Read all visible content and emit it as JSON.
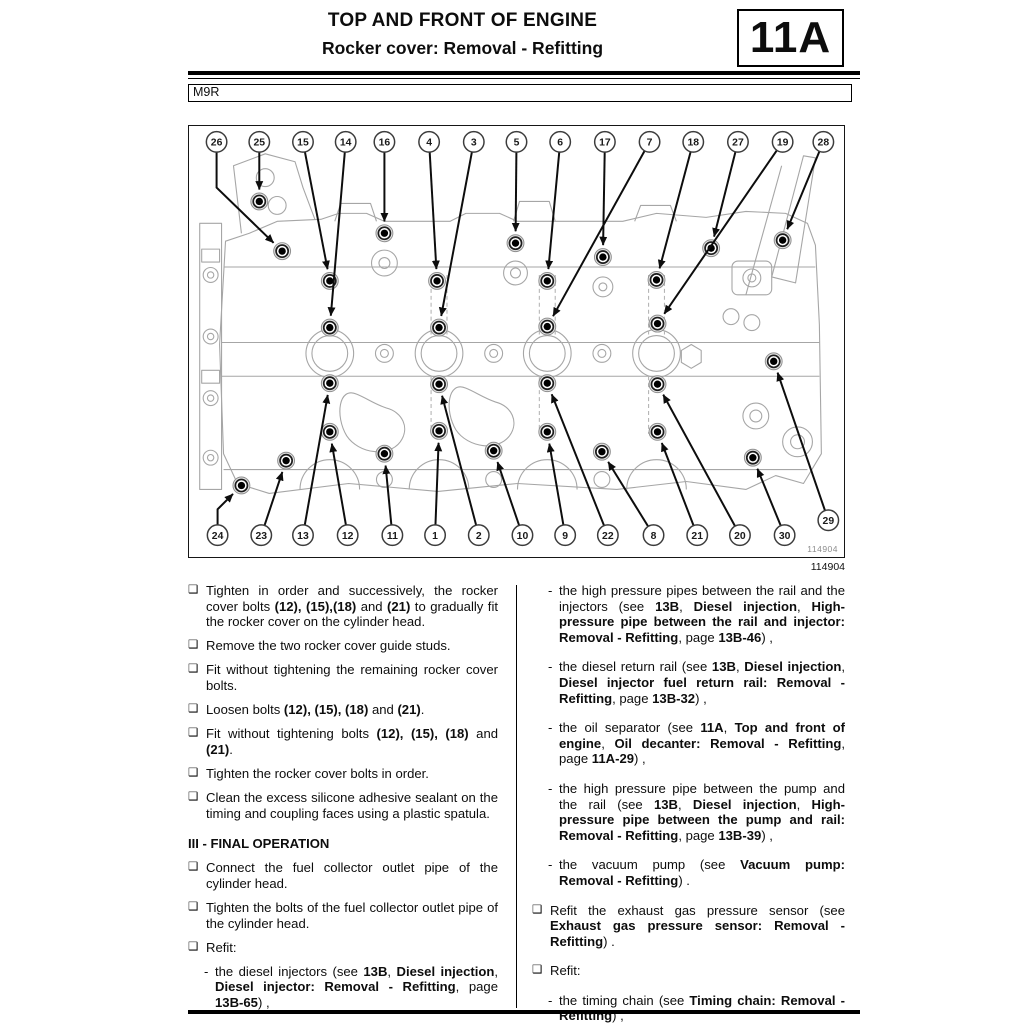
{
  "header": {
    "title_line1": "TOP AND FRONT OF ENGINE",
    "title_line2": "Rocker cover: Removal - Refitting",
    "section_code": "11A",
    "engine_code": "M9R"
  },
  "markers": {
    "bullet": "❑",
    "dash": "-"
  },
  "figure": {
    "image_number": "114904",
    "callouts": [
      {
        "label": "26",
        "c": [
          27,
          16
        ],
        "v": [
          [
            27,
            62
          ]
        ],
        "t": [
          93,
          126
        ]
      },
      {
        "label": "25",
        "c": [
          70,
          16
        ],
        "t": [
          70,
          76
        ]
      },
      {
        "label": "15",
        "c": [
          114,
          16
        ],
        "t": [
          141,
          156
        ]
      },
      {
        "label": "14",
        "c": [
          157,
          16
        ],
        "t": [
          141,
          203
        ]
      },
      {
        "label": "16",
        "c": [
          196,
          16
        ],
        "t": [
          196,
          108
        ]
      },
      {
        "label": "4",
        "c": [
          241,
          16
        ],
        "t": [
          249,
          156
        ]
      },
      {
        "label": "3",
        "c": [
          286,
          16
        ],
        "t": [
          251,
          203
        ]
      },
      {
        "label": "5",
        "c": [
          329,
          16
        ],
        "t": [
          328,
          118
        ]
      },
      {
        "label": "6",
        "c": [
          373,
          16
        ],
        "t": [
          360,
          156
        ]
      },
      {
        "label": "17",
        "c": [
          418,
          16
        ],
        "t": [
          416,
          132
        ]
      },
      {
        "label": "7",
        "c": [
          463,
          16
        ],
        "t": [
          360,
          202
        ]
      },
      {
        "label": "18",
        "c": [
          507,
          16
        ],
        "t": [
          470,
          155
        ]
      },
      {
        "label": "27",
        "c": [
          552,
          16
        ],
        "t": [
          525,
          123
        ]
      },
      {
        "label": "19",
        "c": [
          597,
          16
        ],
        "t": [
          471,
          199
        ]
      },
      {
        "label": "28",
        "c": [
          638,
          16
        ],
        "t": [
          597,
          115
        ]
      },
      {
        "label": "24",
        "c": [
          28,
          412
        ],
        "v": [
          [
            28,
            386
          ]
        ],
        "t": [
          52,
          362
        ]
      },
      {
        "label": "23",
        "c": [
          72,
          412
        ],
        "t": [
          97,
          337
        ]
      },
      {
        "label": "13",
        "c": [
          114,
          412
        ],
        "t": [
          141,
          259
        ]
      },
      {
        "label": "12",
        "c": [
          159,
          412
        ],
        "t": [
          141,
          308
        ]
      },
      {
        "label": "11",
        "c": [
          204,
          412
        ],
        "t": [
          196,
          330
        ]
      },
      {
        "label": "1",
        "c": [
          247,
          412
        ],
        "t": [
          251,
          307
        ]
      },
      {
        "label": "2",
        "c": [
          291,
          412
        ],
        "t": [
          251,
          260
        ]
      },
      {
        "label": "10",
        "c": [
          335,
          412
        ],
        "t": [
          306,
          327
        ]
      },
      {
        "label": "9",
        "c": [
          378,
          412
        ],
        "t": [
          360,
          308
        ]
      },
      {
        "label": "22",
        "c": [
          421,
          412
        ],
        "t": [
          360,
          259
        ]
      },
      {
        "label": "8",
        "c": [
          467,
          412
        ],
        "t": [
          415,
          328
        ]
      },
      {
        "label": "21",
        "c": [
          511,
          412
        ],
        "t": [
          471,
          308
        ]
      },
      {
        "label": "20",
        "c": [
          554,
          412
        ],
        "t": [
          471,
          260
        ]
      },
      {
        "label": "30",
        "c": [
          599,
          412
        ],
        "t": [
          567,
          334
        ]
      },
      {
        "label": "29",
        "c": [
          643,
          397
        ],
        "t": [
          588,
          237
        ]
      }
    ]
  },
  "left_column": {
    "items": [
      {
        "kind": "bullet",
        "segments": [
          {
            "t": "Tighten in order and successively, the rocker cover bolts "
          },
          {
            "t": "(12), (15),(18)",
            "b": true
          },
          {
            "t": " and "
          },
          {
            "t": "(21)",
            "b": true
          },
          {
            "t": " to gradually fit the rocker cover on the cylinder head."
          }
        ]
      },
      {
        "kind": "bullet",
        "segments": [
          {
            "t": "Remove the two rocker cover guide studs."
          }
        ]
      },
      {
        "kind": "bullet",
        "segments": [
          {
            "t": "Fit without tightening the remaining rocker cover bolts."
          }
        ]
      },
      {
        "kind": "bullet",
        "segments": [
          {
            "t": "Loosen bolts "
          },
          {
            "t": "(12), (15), (18)",
            "b": true
          },
          {
            "t": " and "
          },
          {
            "t": "(21)",
            "b": true
          },
          {
            "t": "."
          }
        ]
      },
      {
        "kind": "bullet",
        "segments": [
          {
            "t": "Fit without tightening bolts "
          },
          {
            "t": "(12), (15), (18)",
            "b": true
          },
          {
            "t": " and "
          },
          {
            "t": "(21)",
            "b": true
          },
          {
            "t": "."
          }
        ]
      },
      {
        "kind": "bullet",
        "segments": [
          {
            "t": "Tighten the rocker cover bolts in order."
          }
        ]
      },
      {
        "kind": "bullet",
        "segments": [
          {
            "t": "Clean the excess silicone adhesive sealant on the timing and coupling faces using a plastic spatula."
          }
        ]
      },
      {
        "kind": "heading",
        "segments": [
          {
            "t": "III - FINAL OPERATION"
          }
        ]
      },
      {
        "kind": "bullet",
        "segments": [
          {
            "t": "Connect the fuel collector outlet pipe of the cylinder head."
          }
        ]
      },
      {
        "kind": "bullet",
        "segments": [
          {
            "t": "Tighten the bolts of the fuel collector outlet pipe of the cylinder head."
          }
        ]
      },
      {
        "kind": "bullet",
        "segments": [
          {
            "t": "Refit:"
          }
        ]
      },
      {
        "kind": "dash",
        "segments": [
          {
            "t": "the diesel injectors (see "
          },
          {
            "t": "13B",
            "b": true
          },
          {
            "t": ", "
          },
          {
            "t": "Diesel injection",
            "b": true
          },
          {
            "t": ", "
          },
          {
            "t": "Diesel injector: Removal - Refitting",
            "b": true
          },
          {
            "t": ", page "
          },
          {
            "t": "13B-65",
            "b": true
          },
          {
            "t": ") ,"
          }
        ]
      }
    ]
  },
  "right_column": {
    "items": [
      {
        "kind": "dash",
        "segments": [
          {
            "t": "the high pressure pipes between the rail and the injectors (see "
          },
          {
            "t": "13B",
            "b": true
          },
          {
            "t": ", "
          },
          {
            "t": "Diesel injection",
            "b": true
          },
          {
            "t": ", "
          },
          {
            "t": "High-pressure pipe between the rail and injector: Removal - Refitting",
            "b": true
          },
          {
            "t": ", page "
          },
          {
            "t": "13B-46",
            "b": true
          },
          {
            "t": ") ,"
          }
        ]
      },
      {
        "kind": "dash",
        "segments": [
          {
            "t": "the diesel return rail (see "
          },
          {
            "t": "13B",
            "b": true
          },
          {
            "t": ", "
          },
          {
            "t": "Diesel injection",
            "b": true
          },
          {
            "t": ", "
          },
          {
            "t": "Diesel injector fuel return rail: Removal - Refitting",
            "b": true
          },
          {
            "t": ", page "
          },
          {
            "t": "13B-32",
            "b": true
          },
          {
            "t": ") ,"
          }
        ]
      },
      {
        "kind": "dash",
        "segments": [
          {
            "t": "the oil separator (see "
          },
          {
            "t": "11A",
            "b": true
          },
          {
            "t": ", "
          },
          {
            "t": "Top and front of engine",
            "b": true
          },
          {
            "t": ", "
          },
          {
            "t": "Oil decanter: Removal - Refitting",
            "b": true
          },
          {
            "t": ", page "
          },
          {
            "t": "11A-29",
            "b": true
          },
          {
            "t": ") ,"
          }
        ]
      },
      {
        "kind": "dash",
        "segments": [
          {
            "t": "the high pressure pipe between the pump and the rail (see "
          },
          {
            "t": "13B",
            "b": true
          },
          {
            "t": ", "
          },
          {
            "t": "Diesel injection",
            "b": true
          },
          {
            "t": ", "
          },
          {
            "t": "High-pressure pipe between the pump and rail: Removal - Refitting",
            "b": true
          },
          {
            "t": ", page "
          },
          {
            "t": "13B-39",
            "b": true
          },
          {
            "t": ") ,"
          }
        ]
      },
      {
        "kind": "dash",
        "segments": [
          {
            "t": "the vacuum pump (see "
          },
          {
            "t": "Vacuum pump: Removal - Refitting",
            "b": true
          },
          {
            "t": ") ."
          }
        ]
      },
      {
        "kind": "bullet",
        "segments": [
          {
            "t": "Refit the exhaust gas pressure sensor (see "
          },
          {
            "t": "Exhaust gas pressure sensor: Removal - Refitting",
            "b": true
          },
          {
            "t": ") ."
          }
        ]
      },
      {
        "kind": "bullet",
        "segments": [
          {
            "t": "Refit:"
          }
        ]
      },
      {
        "kind": "dash",
        "segments": [
          {
            "t": "the timing chain (see "
          },
          {
            "t": "Timing chain: Removal - Refitting",
            "b": true
          },
          {
            "t": ") ,"
          }
        ]
      }
    ]
  }
}
